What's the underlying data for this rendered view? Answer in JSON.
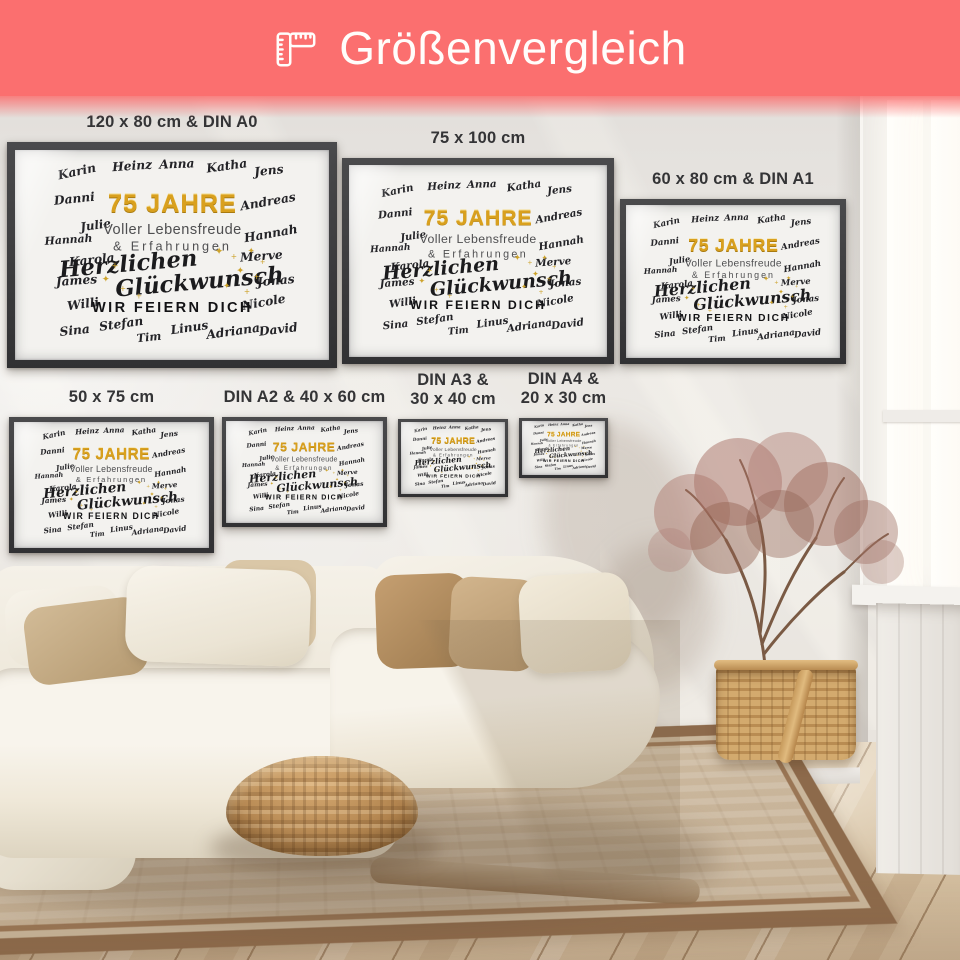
{
  "header": {
    "title": "Größenvergleich",
    "icon": "ruler-icon",
    "colors": {
      "background": "#fb6f6f",
      "text": "#fffdfb"
    }
  },
  "size_labels": [
    {
      "id": "din-a0",
      "lines": [
        "120 x 80 cm & DIN A0"
      ]
    },
    {
      "id": "75x100",
      "lines": [
        "75 x 100 cm"
      ]
    },
    {
      "id": "din-a1",
      "lines": [
        "60 x 80 cm & DIN A1"
      ]
    },
    {
      "id": "50x75",
      "lines": [
        "50 x 75 cm"
      ]
    },
    {
      "id": "din-a2",
      "lines": [
        "DIN A2 & 40 x 60 cm"
      ]
    },
    {
      "id": "din-a3",
      "lines": [
        "DIN A3 &",
        "30 x 40 cm"
      ]
    },
    {
      "id": "din-a4",
      "lines": [
        "DIN A4 &",
        "20 x 30 cm"
      ]
    }
  ],
  "poster_artwork": {
    "headline": "75 JAHRE",
    "subline1": "Voller Lebensfreude",
    "subline2": "& Erfahrungen",
    "script_line1": "Herzlichen",
    "script_line2": "Glückwunsch",
    "footer": "WIR FEIERN DICH",
    "names": [
      "Karin",
      "Heinz",
      "Anna",
      "Katha",
      "Jens",
      "Danni",
      "Andreas",
      "Julie",
      "Hannah",
      "Hannah",
      "Karola",
      "Merve",
      "James",
      "Jonas",
      "Willi",
      "Nicole",
      "Sina",
      "Stefan",
      "Tim",
      "Linus",
      "Adriana",
      "David"
    ],
    "colors": {
      "gold": "#d9a01e",
      "ink": "#1b1b1d",
      "gray": "#4e4e50"
    }
  }
}
